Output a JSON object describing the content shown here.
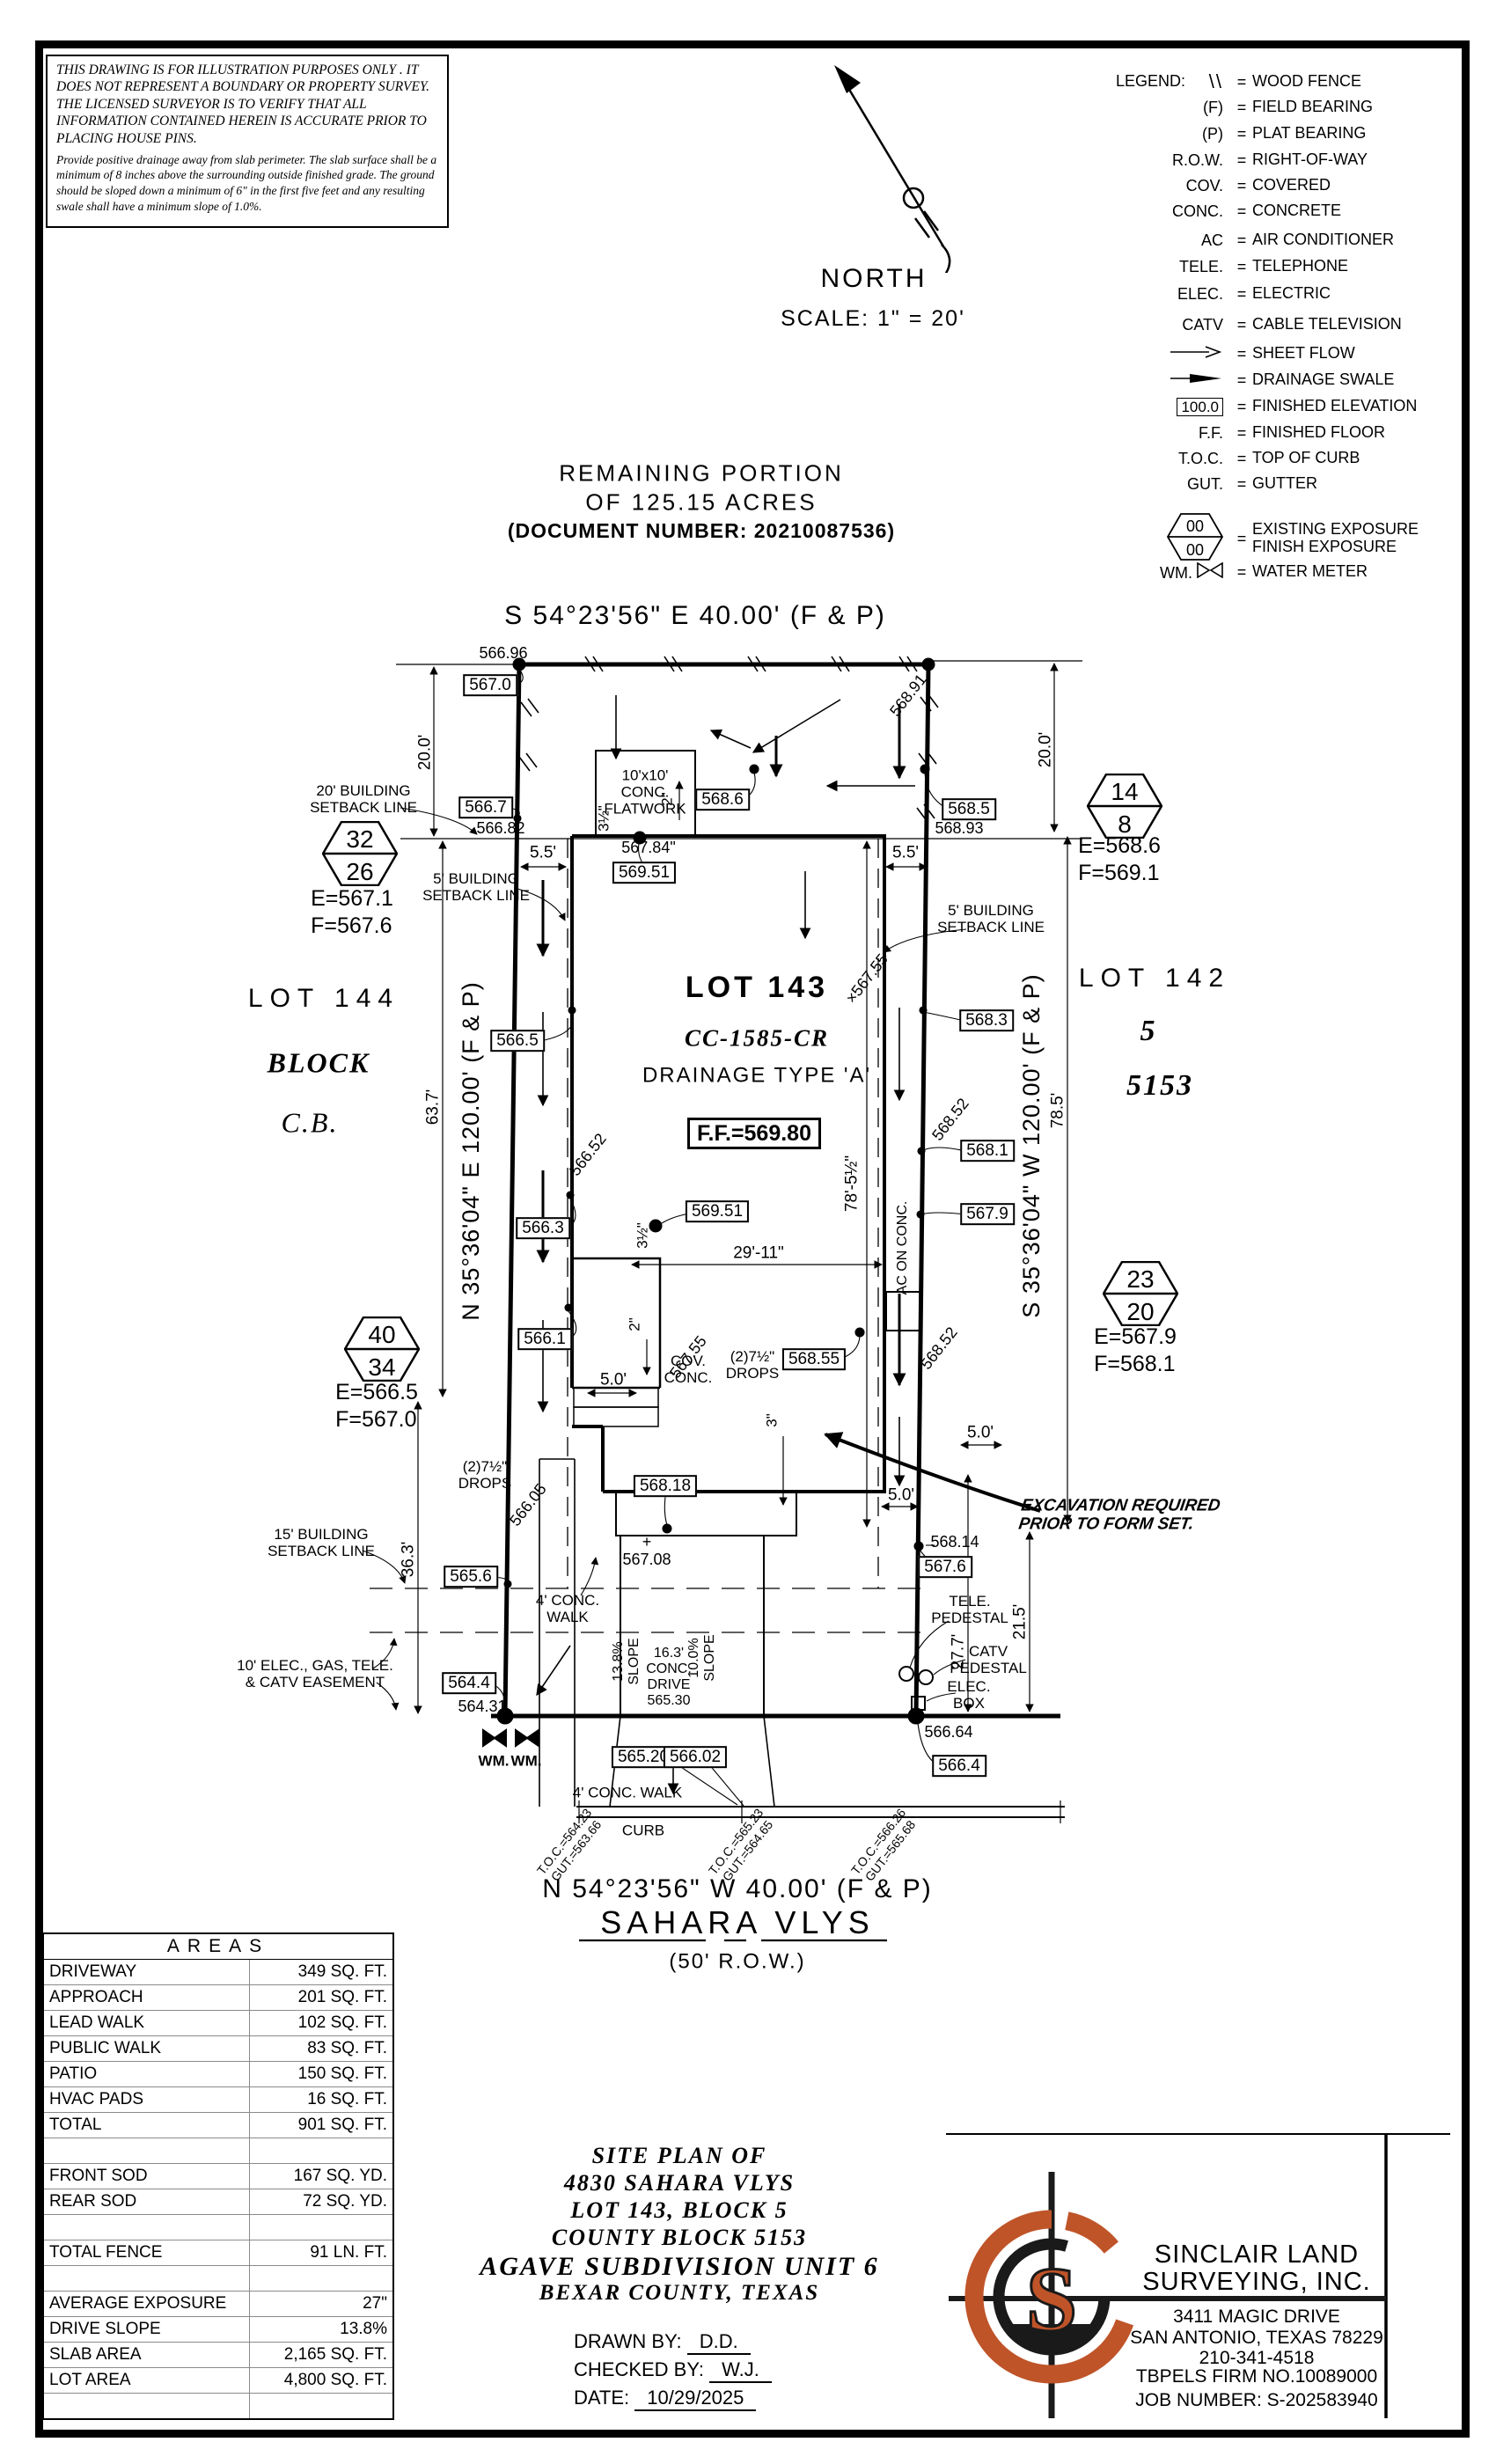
{
  "colors": {
    "accent": "#BF5429",
    "ink": "#000000"
  },
  "disclaimer": {
    "p1": "THIS DRAWING IS FOR ILLUSTRATION PURPOSES ONLY . IT DOES NOT REPRESENT A BOUNDARY OR PROPERTY SURVEY. THE LICENSED SURVEYOR IS TO VERIFY THAT ALL INFORMATION CONTAINED HEREIN IS ACCURATE PRIOR TO PLACING HOUSE PINS.",
    "p2": "Provide positive drainage away from slab perimeter. The slab surface shall be a minimum of 8 inches above the surrounding outside finished grade. The ground should be sloped down a minimum of 6\" in the first five feet and any resulting swale shall have a minimum slope of 1.0%."
  },
  "north": {
    "label": "NORTH",
    "scale": "SCALE: 1\" = 20'"
  },
  "legend": {
    "title": "LEGEND:",
    "fin_elev_value": "100.0",
    "expo_top": "00",
    "expo_bottom": "00",
    "wm_prefix": "WM.",
    "rows": [
      {
        "sym": "\\\\",
        "label": "WOOD FENCE"
      },
      {
        "sym": "(F)",
        "label": "FIELD BEARING"
      },
      {
        "sym": "(P)",
        "label": "PLAT BEARING"
      },
      {
        "sym": "R.O.W.",
        "label": "RIGHT-OF-WAY"
      },
      {
        "sym": "COV.",
        "label": "COVERED"
      },
      {
        "sym": "CONC.",
        "label": "CONCRETE"
      },
      {
        "sym": "AC",
        "label": "AIR CONDITIONER"
      },
      {
        "sym": "TELE.",
        "label": "TELEPHONE"
      },
      {
        "sym": "ELEC.",
        "label": "ELECTRIC"
      },
      {
        "sym": "CATV",
        "label": "CABLE TELEVISION"
      },
      {
        "sym": "",
        "label": "SHEET FLOW"
      },
      {
        "sym": "",
        "label": "DRAINAGE SWALE"
      },
      {
        "sym": "",
        "label": "FINISHED ELEVATION"
      },
      {
        "sym": "F.F.",
        "label": "FINISHED FLOOR"
      },
      {
        "sym": "T.O.C.",
        "label": "TOP OF CURB"
      },
      {
        "sym": "GUT.",
        "label": "GUTTER"
      },
      {
        "sym": "",
        "label": "EXISTING EXPOSURE\nFINISH EXPOSURE"
      },
      {
        "sym": "",
        "label": "WATER METER"
      }
    ]
  },
  "header": {
    "remaining1": "REMAINING PORTION",
    "remaining2": "OF 125.15 ACRES",
    "doc": "(DOCUMENT NUMBER: 20210087536)",
    "bearing_top": "S 54°23'56\" E 40.00' (F & P)"
  },
  "plan": {
    "lot143": {
      "title": "LOT 143",
      "cc": "CC-1585-CR",
      "drainage": "DRAINAGE TYPE 'A'",
      "ff": "F.F.=569.80"
    },
    "lot144": {
      "title": "LOT 144",
      "block": "BLOCK",
      "cb": "C.B."
    },
    "lot142": {
      "title": "LOT 142",
      "block": "5",
      "cb": "5153"
    },
    "bearing_left": "N 35°36'04\" E 120.00' (F & P)",
    "bearing_right": "S 35°36'04\" W 120.00' (F & P)",
    "bearing_bottom": "N 54°23'56\" W 40.00' (F & P)",
    "street": "SAHARA VLYS",
    "row_label": "(50' R.O.W.)",
    "hex": [
      {
        "top": "32",
        "bottom": "26",
        "ef": "E=567.1\nF=567.6"
      },
      {
        "top": "14",
        "bottom": "8",
        "ef": "E=568.6\nF=569.1"
      },
      {
        "top": "40",
        "bottom": "34",
        "ef": "E=566.5\nF=567.0"
      },
      {
        "top": "23",
        "bottom": "20",
        "ef": "E=567.9\nF=568.1"
      }
    ],
    "boxed": [
      "567.0",
      "566.7",
      "566.5",
      "566.3",
      "566.1",
      "565.6",
      "564.4",
      "568.5",
      "568.3",
      "568.1",
      "567.9",
      "567.6",
      "566.4",
      "568.6",
      "569.51",
      "569.51",
      "568.55",
      "568.18",
      "565.20",
      "566.02"
    ],
    "spot": [
      "566.96",
      "566.82",
      "567.84\"",
      "568.93",
      "568.91",
      "566.52",
      "568.52",
      "568.52",
      "566.05",
      "×567.55",
      "567.55",
      "+\n567.08",
      "564.31",
      "566.64",
      "568.14"
    ],
    "dims": [
      "20.0'",
      "20.0'",
      "5.5'",
      "5.5'",
      "63.7'",
      "36.3'",
      "78.5'",
      "21.5'",
      "27.7'",
      "5.0'",
      "5.0'",
      "5.0'",
      "29'-11\"",
      "78'-5½\"",
      "3½\"",
      "3½\"",
      "2\"",
      "2\"",
      "3\""
    ],
    "setbacks": [
      "20' BUILDING\nSETBACK LINE",
      "5' BUILDING\nSETBACK LINE",
      "5' BUILDING\nSETBACK LINE",
      "15' BUILDING\nSETBACK LINE",
      "10' ELEC., GAS, TELE.\n& CATV EASEMENT"
    ],
    "features": [
      "10'x10'\nCONC.\nFLATWORK",
      "AC ON CONC.",
      "COV.\nCONC.",
      "(2)7½\"\nDROPS",
      "(2)7½\"\nDROPS",
      "4' CONC.\nWALK",
      "4' CONC. WALK",
      "CURB",
      "TELE.\nPEDESTAL",
      "CATV\nPEDESTAL",
      "ELEC.\nBOX",
      "WM.",
      "WM.",
      "13.8%\nSLOPE",
      "10.0%\nSLOPE",
      "16.3'\nCONC.\nDRIVE\n565.30",
      "EXCAVATION REQUIRED\nPRIOR TO FORM SET."
    ],
    "toc": [
      "T.O.C.=564.23\nGUT.=563.66",
      "T.O.C.=565.23\nGUT.=564.65",
      "T.O.C.=566.26\nGUT.=565.68"
    ]
  },
  "areas": {
    "title": "AREAS",
    "rows": [
      [
        "DRIVEWAY",
        "349 SQ. FT."
      ],
      [
        "APPROACH",
        "201 SQ. FT."
      ],
      [
        "LEAD WALK",
        "102 SQ. FT."
      ],
      [
        "PUBLIC WALK",
        "83 SQ. FT."
      ],
      [
        "PATIO",
        "150 SQ. FT."
      ],
      [
        "HVAC PADS",
        "16 SQ. FT."
      ],
      [
        "TOTAL",
        "901 SQ. FT."
      ],
      [
        "",
        ""
      ],
      [
        "FRONT SOD",
        "167 SQ. YD."
      ],
      [
        "REAR SOD",
        "72 SQ. YD."
      ],
      [
        "",
        ""
      ],
      [
        "TOTAL FENCE",
        "91 LN. FT."
      ],
      [
        "",
        ""
      ],
      [
        "AVERAGE EXPOSURE",
        "27\""
      ],
      [
        "DRIVE SLOPE",
        "13.8%"
      ],
      [
        "SLAB AREA",
        "2,165 SQ. FT."
      ],
      [
        "LOT AREA",
        "4,800 SQ. FT."
      ],
      [
        "",
        ""
      ]
    ]
  },
  "title_block": {
    "l1": "SITE PLAN OF",
    "l2": "4830 SAHARA VLYS",
    "l3": "LOT 143, BLOCK 5",
    "l4": "COUNTY BLOCK 5153",
    "l5": "AGAVE SUBDIVISION UNIT 6",
    "l6": "BEXAR COUNTY, TEXAS",
    "drawn_label": "DRAWN BY:",
    "drawn": "D.D.",
    "checked_label": "CHECKED BY:",
    "checked": "W.J.",
    "date_label": "DATE:",
    "date": "10/29/2025"
  },
  "firm": {
    "name1": "SINCLAIR LAND",
    "name2": "SURVEYING, INC.",
    "addr1": "3411 MAGIC DRIVE",
    "addr2": "SAN ANTONIO, TEXAS 78229",
    "phone": "210-341-4518",
    "tbpels": "TBPELS FIRM NO.10089000",
    "job": "JOB NUMBER:  S-202583940",
    "logo_letter": "S"
  }
}
